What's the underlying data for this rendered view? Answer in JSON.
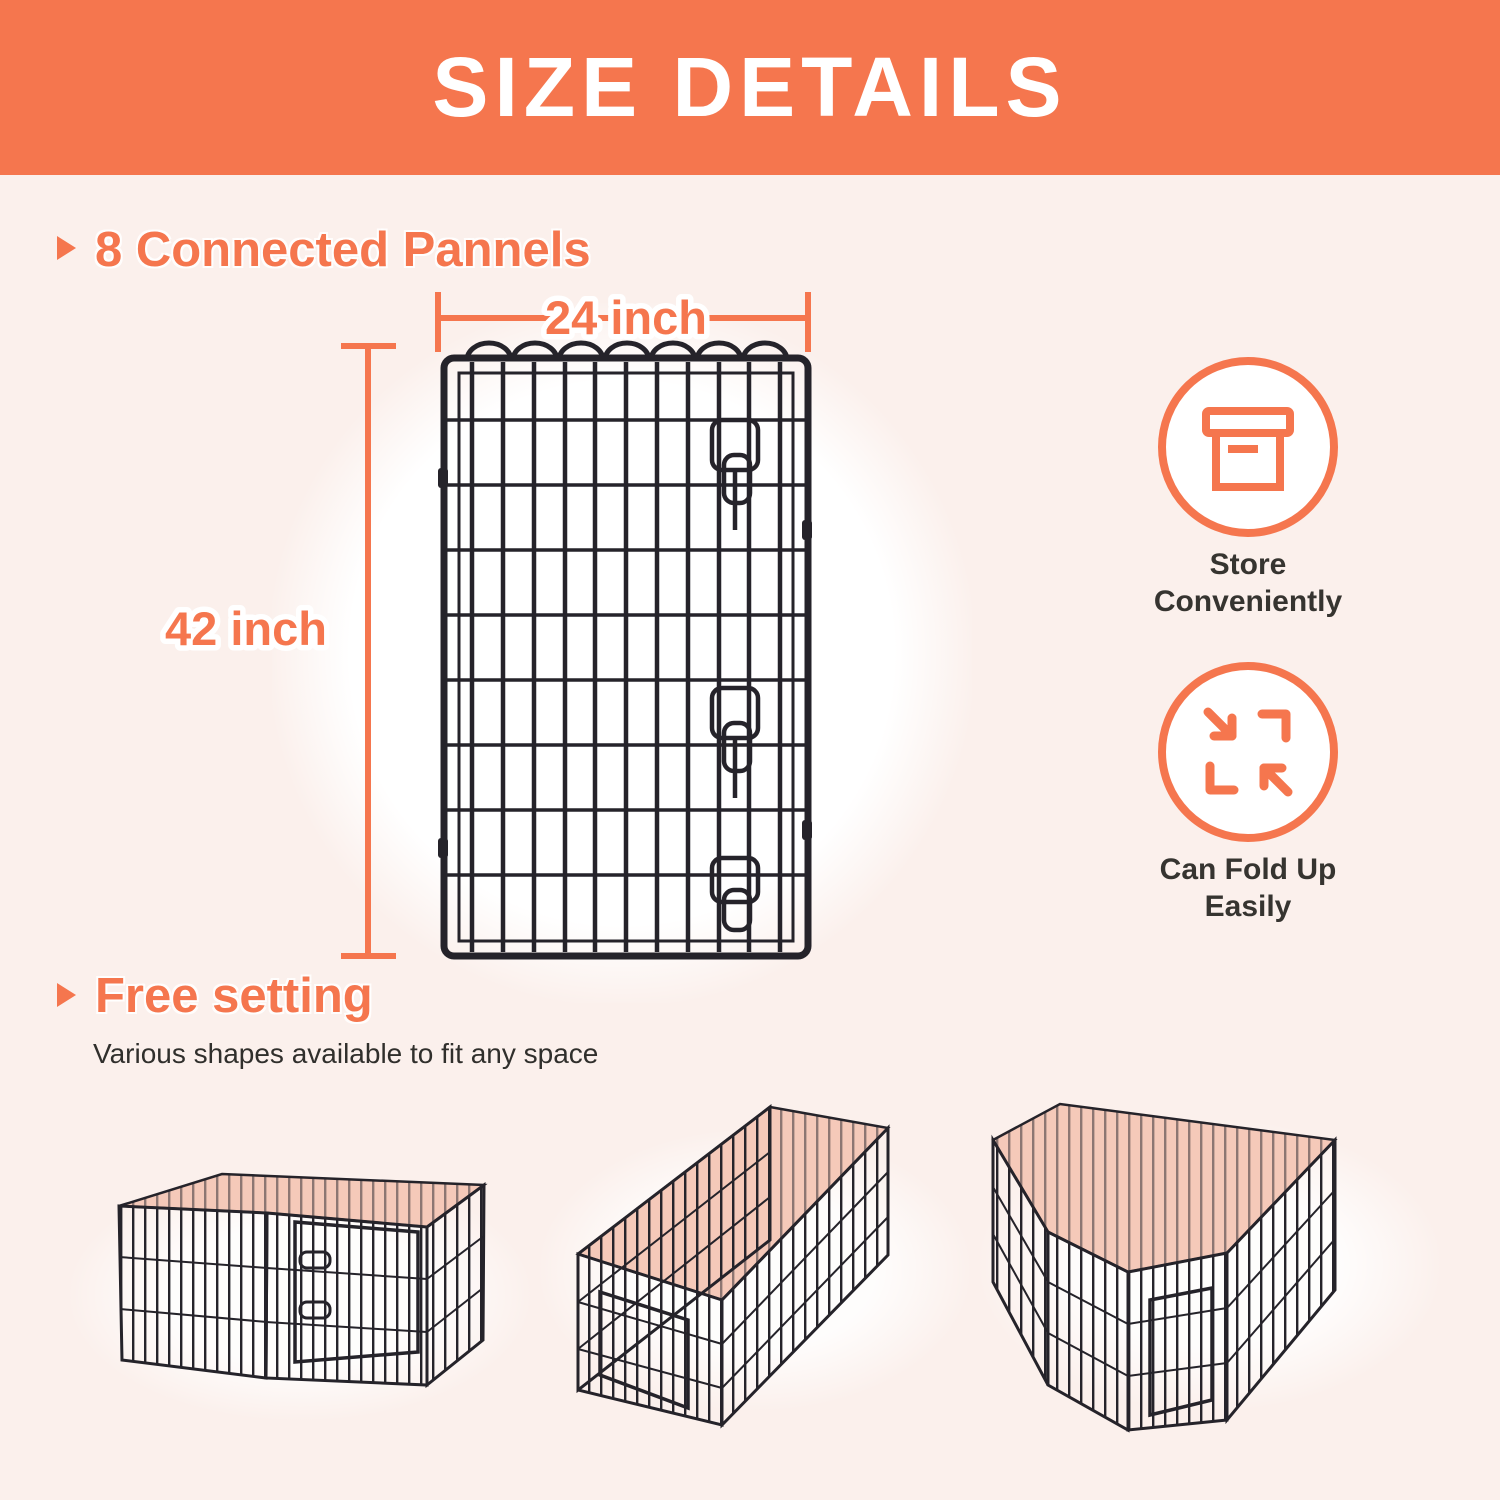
{
  "title_banner": {
    "text": "SIZE DETAILS"
  },
  "colors": {
    "accent": "#F5764E",
    "background": "#FBF0EC",
    "banner_text": "#FFFFFF",
    "dark_text": "#333130",
    "pink_interior": "#F5C9B9",
    "wire": "#25232A",
    "glow": "#FFFFFF"
  },
  "panels_section": {
    "heading": "8 Connected Pannels",
    "width_label": "24 inch",
    "height_label": "42 inch"
  },
  "features": [
    {
      "icon": "storage-box-icon",
      "label": "Store Conveniently"
    },
    {
      "icon": "fold-arrows-icon",
      "label": "Can Fold Up Easily"
    }
  ],
  "free_setting_section": {
    "heading": "Free setting",
    "subtext": "Various shapes available to fit any space",
    "shapes": [
      {
        "name": "square-pen"
      },
      {
        "name": "long-rectangle-pen"
      },
      {
        "name": "l-shape-pen"
      }
    ]
  }
}
